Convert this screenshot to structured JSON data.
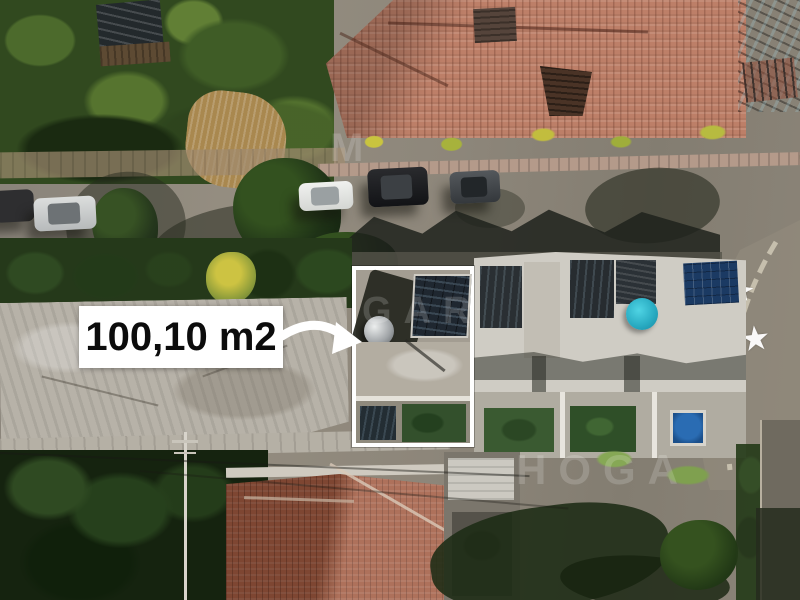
{
  "photo": {
    "description_label": "aerial-drone-view-of-residential-street",
    "scene_items": {
      "big_tile_roof": "terracotta-hip-roof-house",
      "highlighted_property": "white-outlined-lot",
      "street": "asphalt-road-with-parked-cars",
      "bottom_house": "terracotta-roof-house",
      "lawn": "green-backyard"
    }
  },
  "annotation": {
    "area_label": "100,10 m2",
    "label_bg": "#ffffff",
    "label_text_color": "#0c0c0c",
    "arrow_color": "#ffffff",
    "highlight_border_color": "#ffffff"
  },
  "watermark": {
    "fragments": [
      "M",
      "GAR",
      "HOGA"
    ],
    "color": "rgba(255,255,255,0.17)"
  },
  "street_markings": {
    "star_glyph": "★",
    "star_color": "#ffffff",
    "count": 3
  }
}
